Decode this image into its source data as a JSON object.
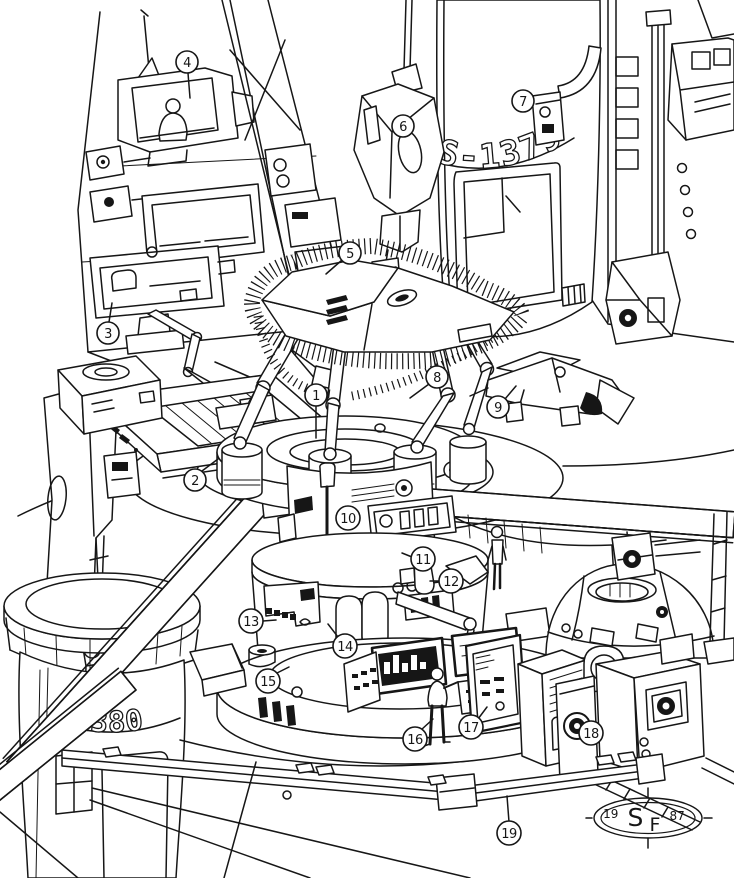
{
  "labels": {
    "rocket_main_id": "S-1379",
    "rocket_secondary_id": "-1380"
  },
  "signature": {
    "prefix": "19",
    "monogram_s": "S",
    "monogram_f": "F",
    "suffix": "87"
  },
  "callouts": [
    {
      "number": "1"
    },
    {
      "number": "2"
    },
    {
      "number": "3"
    },
    {
      "number": "4"
    },
    {
      "number": "5"
    },
    {
      "number": "6"
    },
    {
      "number": "7"
    },
    {
      "number": "8"
    },
    {
      "number": "9"
    },
    {
      "number": "10"
    },
    {
      "number": "11"
    },
    {
      "number": "12"
    },
    {
      "number": "13"
    },
    {
      "number": "14"
    },
    {
      "number": "15"
    },
    {
      "number": "16"
    },
    {
      "number": "17"
    },
    {
      "number": "18"
    },
    {
      "number": "19"
    }
  ]
}
